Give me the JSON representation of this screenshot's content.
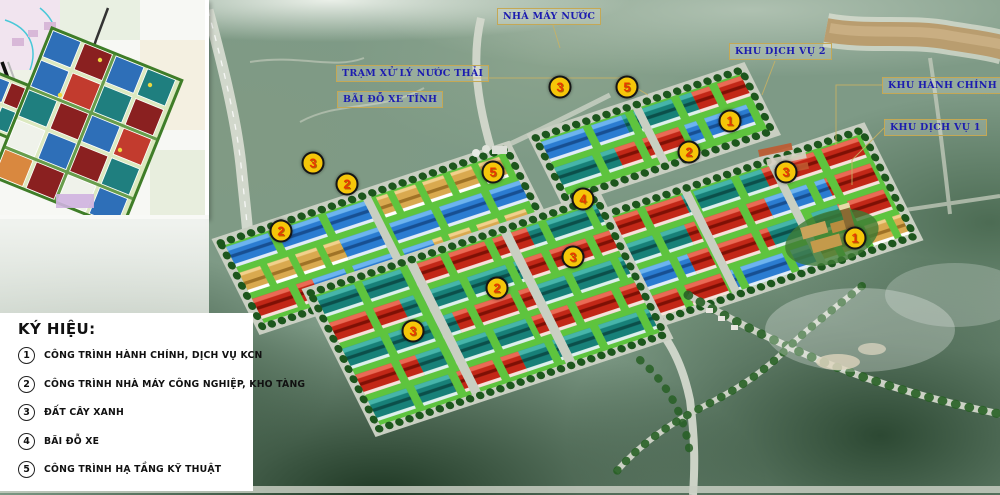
{
  "legend": {
    "title": "KÝ HIỆU:",
    "items": [
      {
        "num": "1",
        "label": "CÔNG TRÌNH HÀNH CHÍNH, DỊCH VỤ KCN"
      },
      {
        "num": "2",
        "label": "CÔNG TRÌNH NHÀ MÁY CÔNG NGHIỆP, KHO TÀNG"
      },
      {
        "num": "3",
        "label": "ĐẤT CÂY XANH"
      },
      {
        "num": "4",
        "label": "BÃI ĐỖ XE"
      },
      {
        "num": "5",
        "label": "CÔNG TRÌNH HẠ TẦNG KỸ THUẬT"
      }
    ]
  },
  "area_labels": [
    {
      "text": "NHÀ MÁY NƯỚC",
      "x": 497,
      "y": 8
    },
    {
      "text": "KHU DỊCH VỤ 2",
      "x": 729,
      "y": 43
    },
    {
      "text": "TRẠM XỬ LÝ NƯỚC THẢI",
      "x": 336,
      "y": 65
    },
    {
      "text": "BÃI ĐỖ XE TĨNH",
      "x": 337,
      "y": 91
    },
    {
      "text": "KHU HÀNH CHÍNH",
      "x": 882,
      "y": 77
    },
    {
      "text": "KHU DỊCH VỤ 1",
      "x": 884,
      "y": 119
    }
  ],
  "markers": [
    {
      "num": "3",
      "x": 313,
      "y": 163
    },
    {
      "num": "2",
      "x": 347,
      "y": 184
    },
    {
      "num": "2",
      "x": 281,
      "y": 231
    },
    {
      "num": "5",
      "x": 493,
      "y": 172
    },
    {
      "num": "3",
      "x": 560,
      "y": 87
    },
    {
      "num": "5",
      "x": 627,
      "y": 87
    },
    {
      "num": "1",
      "x": 730,
      "y": 121
    },
    {
      "num": "2",
      "x": 689,
      "y": 152
    },
    {
      "num": "4",
      "x": 583,
      "y": 199
    },
    {
      "num": "3",
      "x": 786,
      "y": 172
    },
    {
      "num": "3",
      "x": 573,
      "y": 257
    },
    {
      "num": "2",
      "x": 497,
      "y": 288
    },
    {
      "num": "3",
      "x": 413,
      "y": 331
    },
    {
      "num": "1",
      "x": 855,
      "y": 238
    }
  ],
  "colors": {
    "marker_fill": "#f6c609",
    "marker_border": "#151515",
    "marker_number": "#e63900",
    "label_text": "#1c1cb0",
    "label_border": "#c4a855",
    "roof_blue": "#2b7cd1",
    "roof_teal": "#178078",
    "roof_red": "#c22717",
    "roof_tan": "#d9a94f",
    "grass": "#5ec43e",
    "road": "#c9cfc2",
    "river": "#b99d6f",
    "tree": "#1d561d"
  }
}
